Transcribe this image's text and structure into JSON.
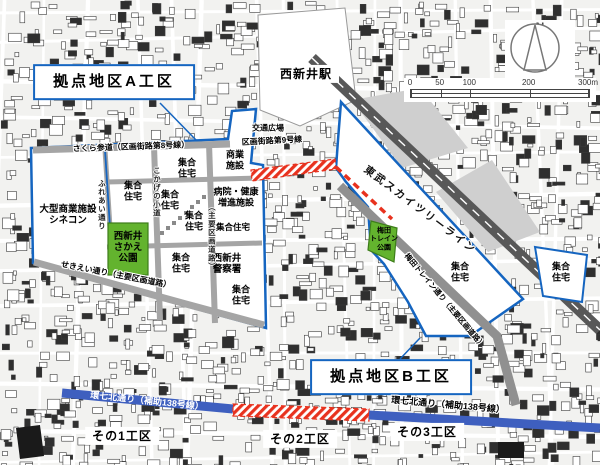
{
  "map_title_context": "西新井駅西口周辺 土地区画整理 計画図",
  "colors": {
    "boundary_blue": "#1565c0",
    "road_blue": "#3e5fbf",
    "road_red": "#e8321e",
    "park_green": "#63b32e",
    "rail_gray": "#585858"
  },
  "compass": {
    "north_label": "N"
  },
  "scale_bar": {
    "ticks": [
      "0",
      "50",
      "100",
      "200",
      "300m"
    ],
    "values": [
      0,
      50,
      100,
      200,
      300
    ],
    "max": 300
  },
  "map_labels": [
    {
      "id": "label-area-a",
      "text": "拠点地区A工区",
      "x": 114,
      "y": 82,
      "fs": 15,
      "rot": 0,
      "type": "box-blue"
    },
    {
      "id": "label-area-b",
      "text": "拠点地区B工区",
      "x": 391,
      "y": 377,
      "fs": 15,
      "rot": 0,
      "type": "box-blue"
    },
    {
      "id": "label-station",
      "text": "西新井駅",
      "x": 306,
      "y": 74,
      "fs": 12,
      "rot": 0,
      "type": "box-white"
    },
    {
      "id": "label-sub-district-1",
      "text": "その1工区",
      "x": 122,
      "y": 436,
      "fs": 12,
      "rot": 0,
      "type": "box-white"
    },
    {
      "id": "label-sub-district-2",
      "text": "その2工区",
      "x": 300,
      "y": 439,
      "fs": 12,
      "rot": 0,
      "type": "box-white"
    },
    {
      "id": "label-sub-district-3",
      "text": "その3工区",
      "x": 427,
      "y": 432,
      "fs": 12,
      "rot": 0,
      "type": "box-white"
    },
    {
      "id": "label-road-sakura",
      "text": "さくら参道（区画街路第8号線）",
      "x": 131,
      "y": 147,
      "fs": 8,
      "rot": -2,
      "type": "halo"
    },
    {
      "id": "label-road-gai9",
      "text": "区画街路第9号線",
      "x": 272,
      "y": 141,
      "fs": 8,
      "rot": -3,
      "type": "halo"
    },
    {
      "id": "label-traffic-plaza",
      "text": "交通広場",
      "x": 268,
      "y": 128,
      "fs": 8,
      "rot": 0,
      "type": "halo"
    },
    {
      "id": "label-commercial",
      "text": "商業\n施設",
      "x": 235,
      "y": 160,
      "fs": 9,
      "rot": 0,
      "type": "plain"
    },
    {
      "id": "label-hospital",
      "text": "病院・健康\n増進施設",
      "x": 236,
      "y": 197,
      "fs": 9,
      "rot": 0,
      "type": "plain"
    },
    {
      "id": "label-housing-1",
      "text": "集合\n住宅",
      "x": 187,
      "y": 168,
      "fs": 9,
      "rot": 0,
      "type": "plain"
    },
    {
      "id": "label-housing-2",
      "text": "集合\n住宅",
      "x": 133,
      "y": 191,
      "fs": 9,
      "rot": 0,
      "type": "plain"
    },
    {
      "id": "label-housing-3",
      "text": "集合\n住宅",
      "x": 170,
      "y": 200,
      "fs": 9,
      "rot": 0,
      "type": "plain"
    },
    {
      "id": "label-housing-4",
      "text": "集合\n住宅",
      "x": 194,
      "y": 221,
      "fs": 9,
      "rot": 0,
      "type": "plain"
    },
    {
      "id": "label-housing-5",
      "text": "集合住宅",
      "x": 233,
      "y": 227,
      "fs": 8.5,
      "rot": 0,
      "type": "plain"
    },
    {
      "id": "label-housing-6",
      "text": "集合\n住宅",
      "x": 181,
      "y": 263,
      "fs": 9,
      "rot": 0,
      "type": "plain"
    },
    {
      "id": "label-housing-7",
      "text": "集合\n住宅",
      "x": 241,
      "y": 295,
      "fs": 9,
      "rot": 0,
      "type": "plain"
    },
    {
      "id": "label-housing-8",
      "text": "集合\n住宅",
      "x": 460,
      "y": 272,
      "fs": 9,
      "rot": 0,
      "type": "plain"
    },
    {
      "id": "label-housing-9",
      "text": "集合\n住宅",
      "x": 561,
      "y": 272,
      "fs": 9,
      "rot": 0,
      "type": "plain"
    },
    {
      "id": "label-cinecon",
      "text": "大型商業施設\nシネコン",
      "x": 68,
      "y": 215,
      "fs": 9.5,
      "rot": 0,
      "type": "plain"
    },
    {
      "id": "label-sakae-park",
      "text": "西新井\nさかえ\n公園",
      "x": 128,
      "y": 248,
      "fs": 9.5,
      "rot": 0,
      "type": "plain"
    },
    {
      "id": "label-police",
      "text": "西新井\n警察署",
      "x": 227,
      "y": 264,
      "fs": 9.5,
      "rot": 0,
      "type": "plain"
    },
    {
      "id": "label-train-park",
      "text": "梅田\nトレイン\n公園",
      "x": 384,
      "y": 240,
      "fs": 7,
      "rot": 0,
      "type": "plain"
    },
    {
      "id": "label-tobu-skytree-line",
      "text": "東武スカイツリーライン",
      "x": 420,
      "y": 210,
      "fs": 10.5,
      "rot": 37,
      "type": "tobu"
    },
    {
      "id": "label-road-train",
      "text": "梅田トレイン通り（主要区画道路）",
      "x": 444,
      "y": 301,
      "fs": 7.5,
      "rot": 50,
      "type": "halo"
    },
    {
      "id": "label-road-sekiei",
      "text": "せきえい通り（主要区画道路）",
      "x": 116,
      "y": 275,
      "fs": 8,
      "rot": 11,
      "type": "halo"
    },
    {
      "id": "label-road-fureai",
      "text": "ふれあい通り",
      "x": 101,
      "y": 205,
      "fs": 7.5,
      "rot": 0,
      "type": "vert"
    },
    {
      "id": "label-road-komichi",
      "text": "こかげの小道",
      "x": 156,
      "y": 192,
      "fs": 7.5,
      "rot": 0,
      "type": "vert"
    },
    {
      "id": "label-road-shuyo",
      "text": "（主要区画道路）",
      "x": 211,
      "y": 237,
      "fs": 7.5,
      "rot": 0,
      "type": "vert"
    },
    {
      "id": "label-road-kannana-left",
      "text": "環七北通り（補助138号線）",
      "x": 147,
      "y": 401,
      "fs": 9,
      "rot": 6,
      "type": "on-blue"
    },
    {
      "id": "label-road-kannana-right",
      "text": "環七北通り（補助138号線）",
      "x": 448,
      "y": 405,
      "fs": 9,
      "rot": 5,
      "type": "halo"
    }
  ]
}
